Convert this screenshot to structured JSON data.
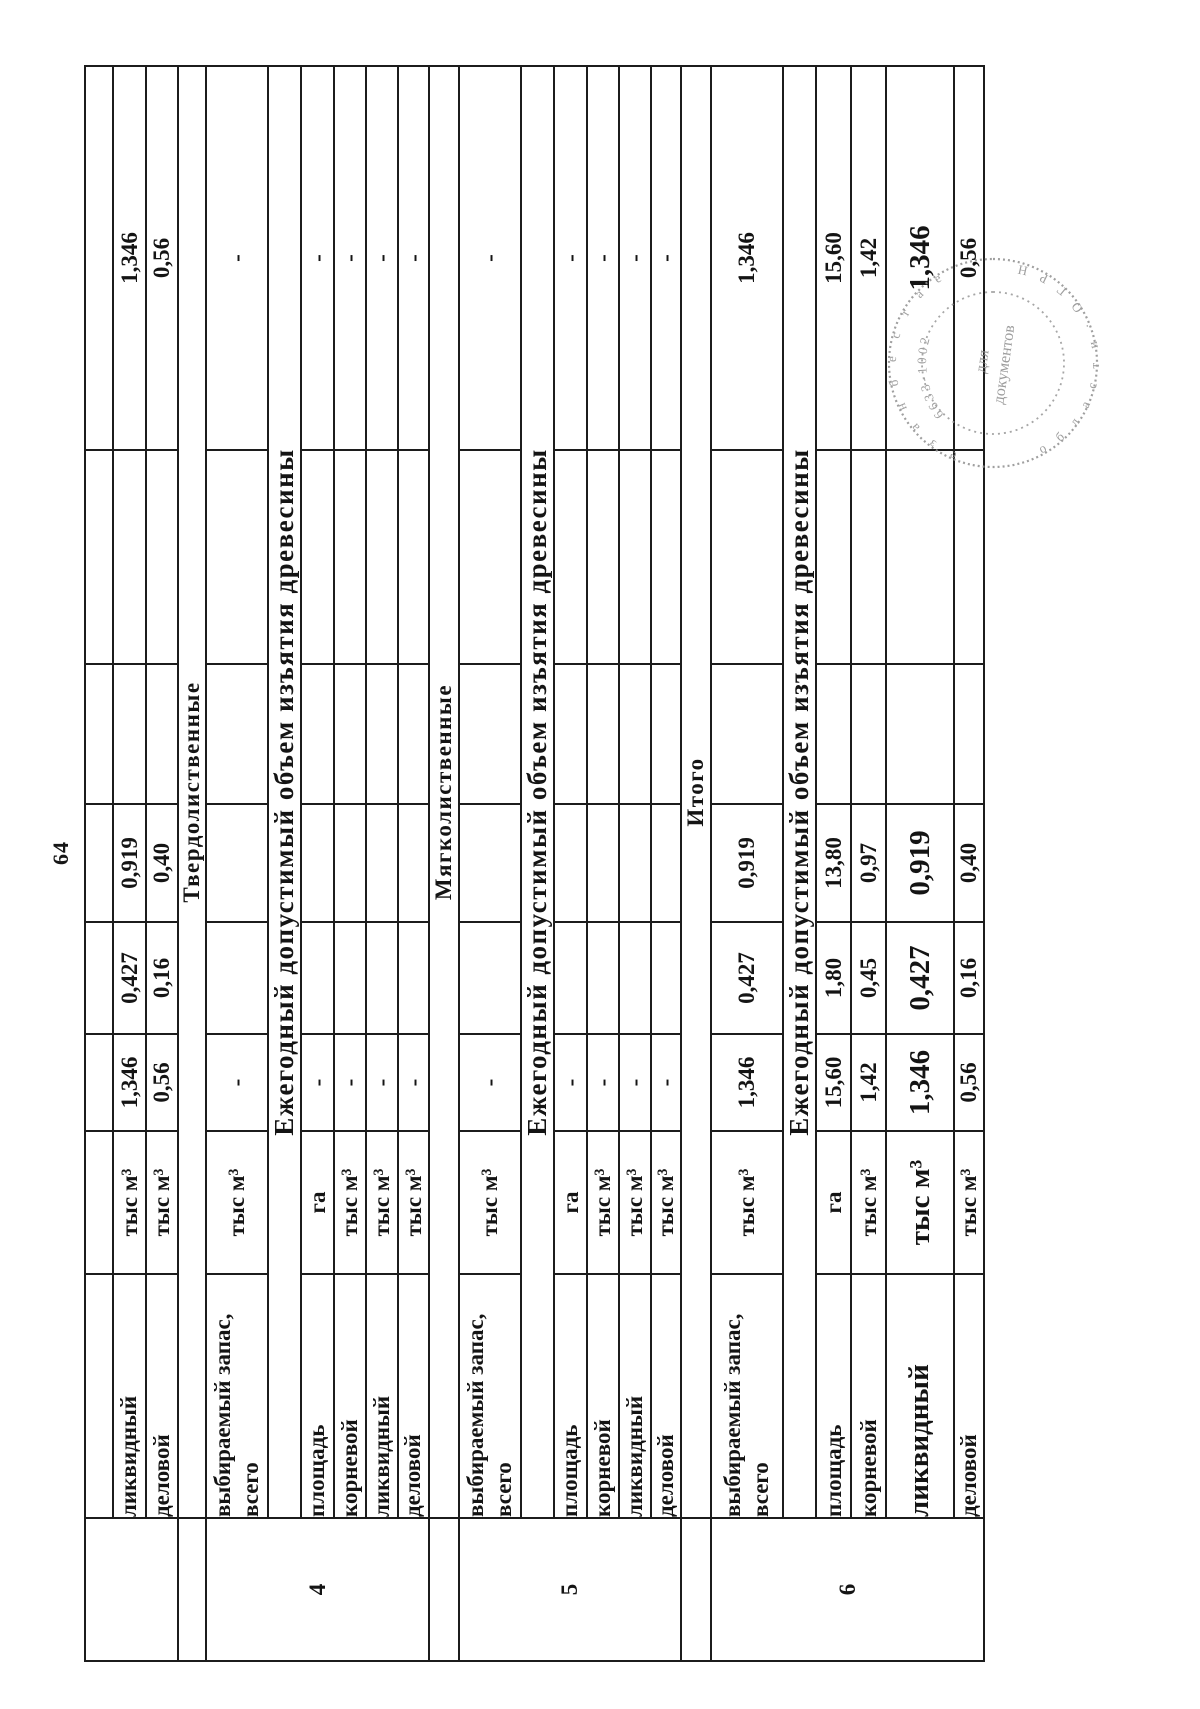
{
  "page": {
    "number": "64"
  },
  "table": {
    "sections": [
      {
        "num": "",
        "header": null,
        "subheader": null,
        "rows": [
          {
            "label": "ликвидный",
            "unit": "тыс м³",
            "vals": [
              "1,346",
              "0,427",
              "0,919",
              "",
              "",
              "1,346"
            ]
          },
          {
            "label": "деловой",
            "unit": "тыс м³",
            "vals": [
              "0,56",
              "0,16",
              "0,40",
              "",
              "",
              "0,56"
            ]
          }
        ]
      },
      {
        "num": "4",
        "header": "Твердолиственные",
        "subheader": "Ежегодный допустимый объем изъятия древесины",
        "rows": [
          {
            "label": "выбираемый запас, всего",
            "unit": "тыс м³",
            "vals": [
              "-",
              "",
              "",
              "",
              "",
              "-"
            ]
          },
          {
            "label": "площадь",
            "unit": "га",
            "vals": [
              "-",
              "",
              "",
              "",
              "",
              "-"
            ]
          },
          {
            "label": "корневой",
            "unit": "тыс м³",
            "vals": [
              "-",
              "",
              "",
              "",
              "",
              "-"
            ]
          },
          {
            "label": "ликвидный",
            "unit": "тыс м³",
            "vals": [
              "-",
              "",
              "",
              "",
              "",
              "-"
            ]
          },
          {
            "label": "деловой",
            "unit": "тыс м³",
            "vals": [
              "-",
              "",
              "",
              "",
              "",
              "-"
            ]
          }
        ]
      },
      {
        "num": "5",
        "header": "Мягколиственные",
        "subheader": "Ежегодный допустимый объем изъятия древесины",
        "rows": [
          {
            "label": "выбираемый запас, всего",
            "unit": "тыс м³",
            "vals": [
              "-",
              "",
              "",
              "",
              "",
              "-"
            ]
          },
          {
            "label": "площадь",
            "unit": "га",
            "vals": [
              "-",
              "",
              "",
              "",
              "",
              "-"
            ]
          },
          {
            "label": "корневой",
            "unit": "тыс м³",
            "vals": [
              "-",
              "",
              "",
              "",
              "",
              "-"
            ]
          },
          {
            "label": "ликвидный",
            "unit": "тыс м³",
            "vals": [
              "-",
              "",
              "",
              "",
              "",
              "-"
            ]
          },
          {
            "label": "деловой",
            "unit": "тыс м³",
            "vals": [
              "-",
              "",
              "",
              "",
              "",
              "-"
            ]
          }
        ]
      },
      {
        "num": "6",
        "header": "Итого",
        "subheader": "Ежегодный допустимый объем изъятия древесины",
        "rows": [
          {
            "label": "выбираемый запас, всего",
            "unit": "тыс м³",
            "vals": [
              "1,346",
              "0,427",
              "0,919",
              "",
              "",
              "1,346"
            ]
          },
          {
            "label": "площадь",
            "unit": "га",
            "vals": [
              "15,60",
              "1,80",
              "13,80",
              "",
              "",
              "15,60"
            ]
          },
          {
            "label": "корневой",
            "unit": "тыс м³",
            "vals": [
              "1,42",
              "0,45",
              "0,97",
              "",
              "",
              "1,42"
            ]
          },
          {
            "label": "ликвидный",
            "unit": "тыс м³",
            "vals": [
              "1,346",
              "0,427",
              "0,919",
              "",
              "",
              "1,346"
            ]
          },
          {
            "label": "деловой",
            "unit": "тыс м³",
            "vals": [
              "0,56",
              "0,16",
              "0,40",
              "",
              "",
              "0,56"
            ]
          }
        ]
      }
    ]
  },
  "stamp": {
    "center_line1": "для",
    "center_line2": "документов",
    "digits": "6633-1002",
    "ring_top": "е з а н б е с т а е",
    "ring_bottom": "о б л а с т и · О Г Р Н"
  }
}
